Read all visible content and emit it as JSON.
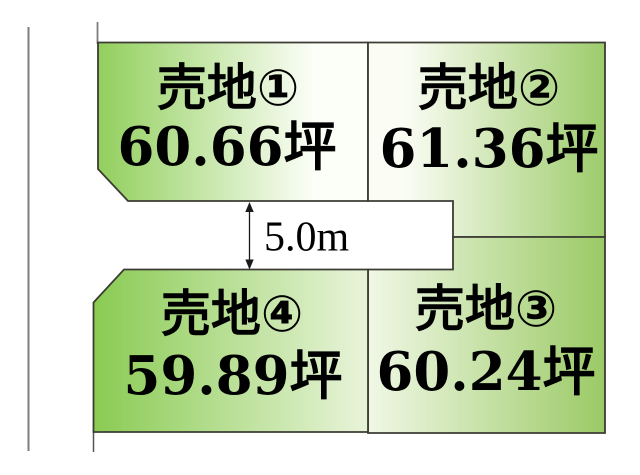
{
  "diagram": {
    "type": "land-subdivision-plan",
    "road": {
      "width_label": "5.0m"
    },
    "plots": [
      {
        "id": "1",
        "name": "売地①",
        "area": "60.66坪"
      },
      {
        "id": "2",
        "name": "売地②",
        "area": "61.36坪"
      },
      {
        "id": "3",
        "name": "売地③",
        "area": "60.24坪"
      },
      {
        "id": "4",
        "name": "売地④",
        "area": "59.89坪"
      }
    ],
    "colors": {
      "green_1": "#92cf5d",
      "green_2": "#9dcc6b",
      "green_3": "#9bca66",
      "green_4": "#8acb53",
      "pale_1": "#fcfef8",
      "pale_2": "#fbfdf5",
      "pale_3": "#f0f8e6",
      "pale_4": "#e9f4da",
      "outline": "#3c3c34",
      "boundary_gray": "#7e7e7e",
      "stub_dark": "#555550",
      "arrow_black": "#1a1a1a",
      "background": "#ffffff"
    }
  }
}
